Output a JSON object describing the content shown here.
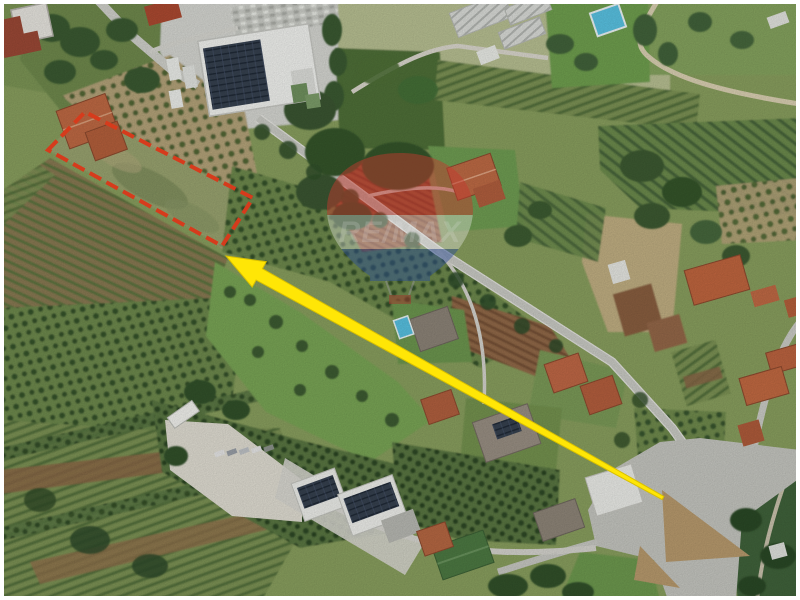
{
  "meta": {
    "type": "aerial-photo-listing",
    "description": "Aerial satellite photo of rural land (olive groves, vineyards, tilled fields, scattered houses, industrial sheds, road junction) with a parcel for sale outlined in red and a yellow arrow pointing to it"
  },
  "watermark": {
    "text": "RE/MAX",
    "center": [
      400,
      215
    ],
    "opacity": 0.48,
    "balloon_red": "#c5392e",
    "balloon_white": "#f2f2f2",
    "balloon_blue": "#2d4e96",
    "text_color": "#ededed"
  },
  "annotations": {
    "parcel_outline": {
      "shape": "quadrilateral",
      "points": [
        [
          48,
          150
        ],
        [
          85,
          112
        ],
        [
          253,
          198
        ],
        [
          222,
          246
        ]
      ],
      "color": "#d63b1c",
      "stroke_width": 4,
      "dash": "13 6"
    },
    "direction_arrow": {
      "color": "#ffe606",
      "edge_color": "#d8bf00",
      "tip": [
        226,
        256
      ],
      "tail": [
        663,
        498
      ],
      "head_length": 38,
      "head_half_width": 14.5,
      "shaft_half_width_at_head": 6.5,
      "shaft_half_width_at_tail": 1.8
    }
  },
  "scene": {
    "border_color": "#ffffff",
    "palette": {
      "field_green": "#8aa05f",
      "meadow_green": "#7aa656",
      "tree_green": "#3a5a31",
      "olive_ground_tan": "#b5a47a",
      "tilled_brown": "#936a48",
      "road_gray": "#cbccc6",
      "roof_orange": "#c0693f",
      "roof_red": "#9c4936",
      "pool_blue": "#58c2e2",
      "solar_panel": "#333e4d",
      "warehouse_green": "#4d7a43"
    },
    "features": [
      "olive groves",
      "vineyard rows",
      "tilled fields",
      "greenhouses",
      "industrial building with solar panels",
      "warehouses",
      "residential houses",
      "swimming pools",
      "country roads",
      "road junction"
    ]
  }
}
